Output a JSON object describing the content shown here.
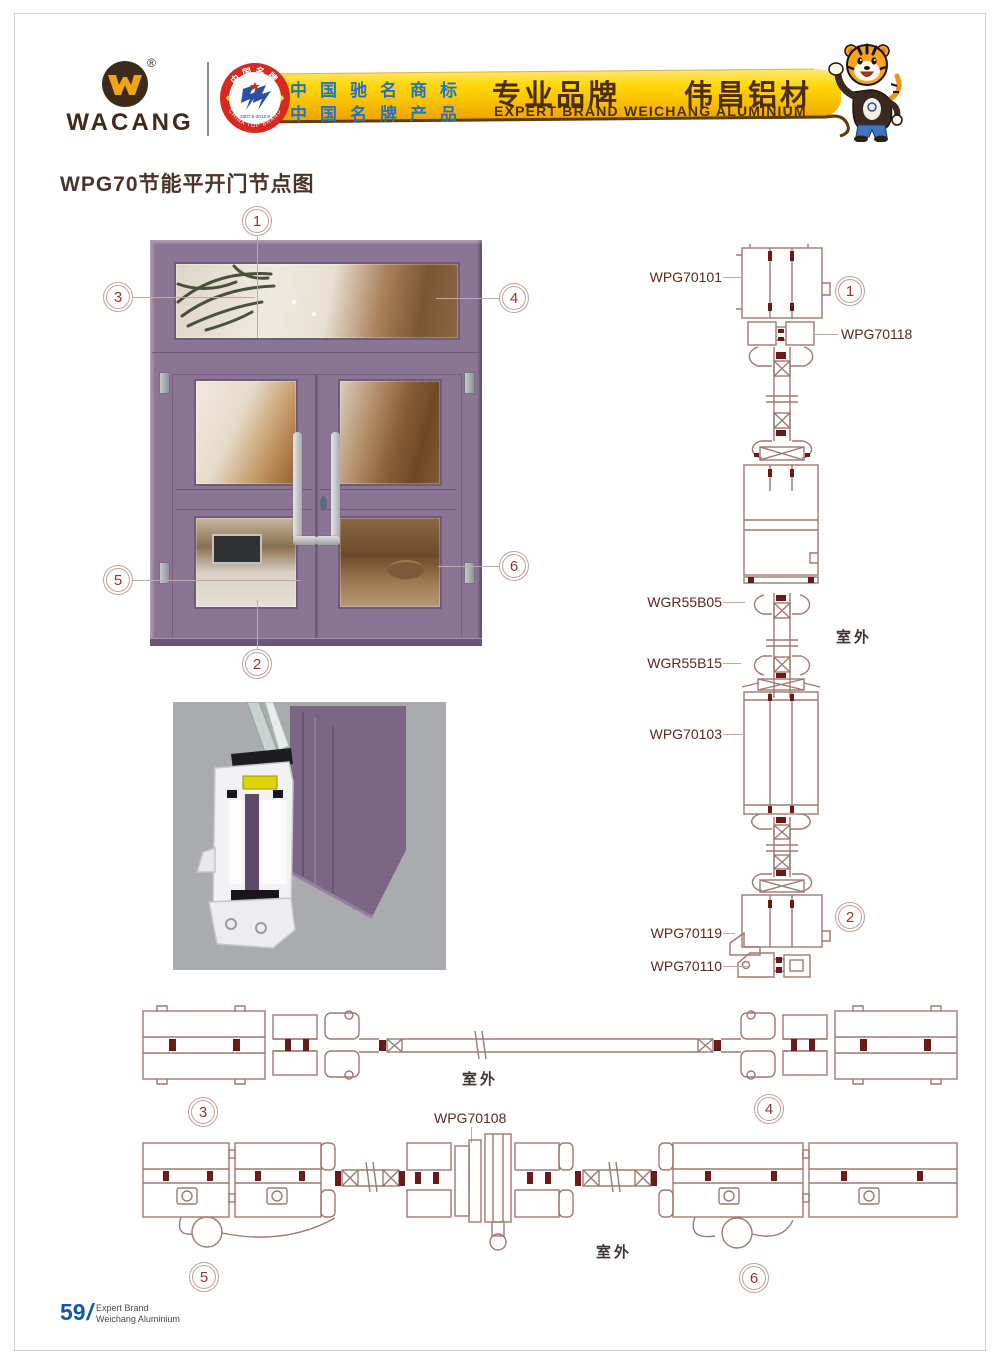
{
  "header": {
    "logo": {
      "text": "WACANG",
      "reg": "®"
    },
    "badge": {
      "arc_top": "中国名牌",
      "arc_bottom": "CHINA TOP BRAND",
      "years": "2007.9-2012.9"
    },
    "banner": {
      "cn_line1": "中国驰名商标",
      "cn_line2": "中国名牌产品",
      "main_cn": "专业品牌　　伟昌铝材",
      "sub_en": "EXPERT BRAND WEICHANG ALUMINIUM"
    }
  },
  "page_title": "WPG70节能平开门节点图",
  "elevation": {
    "callout_1": "1",
    "callout_2": "2",
    "callout_3": "3",
    "callout_4": "4",
    "callout_5": "5",
    "callout_6": "6"
  },
  "vertical_section": {
    "label_wpg70101": "WPG70101",
    "label_wpg70118": "WPG70118",
    "label_wgr55b05": "WGR55B05",
    "label_wgr55b15": "WGR55B15",
    "label_wpg70103": "WPG70103",
    "label_wpg70119": "WPG70119",
    "label_wpg70110": "WPG70110",
    "outdoor": "室外",
    "callout_1": "1",
    "callout_2": "2"
  },
  "horizontal_section_top": {
    "outdoor": "室外",
    "callout_3": "3",
    "callout_4": "4"
  },
  "horizontal_section_bottom": {
    "label_wpg70108": "WPG70108",
    "outdoor": "室外",
    "callout_5": "5",
    "callout_6": "6"
  },
  "footer": {
    "page_number": "59",
    "slash": "/",
    "line1": "Expert Brand",
    "line2": "Weichang Aluminium"
  },
  "colors": {
    "banner_gold": "#fccf04",
    "brand_brown": "#3e2b1d",
    "banner_text_blue": "#2472c2",
    "banner_text_brown": "#4e2d0b",
    "badge_red": "#d62a20",
    "title_brown": "#4c3228",
    "door_purple": "#8a7594",
    "drawing_taupe": "#9b7a71",
    "accent_dark_red": "#6a1a18",
    "callout_red": "#8c382e",
    "label_maroon": "#59291f",
    "footer_blue": "#1456a8"
  }
}
